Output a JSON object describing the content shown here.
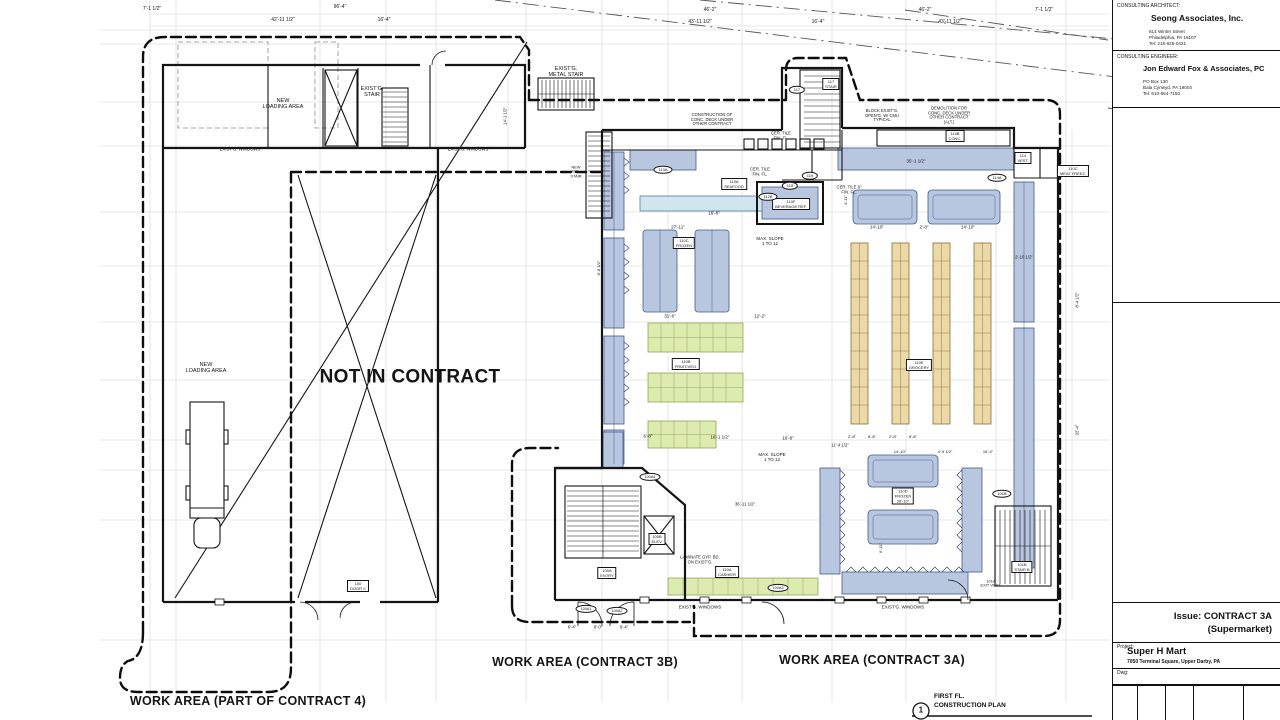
{
  "colors": {
    "fixture_blue": "#b9c6e0",
    "fixture_blue_border": "#44598c",
    "aqua": "#cfe6f0",
    "produce_green": "#dcebae",
    "produce_border": "#98a35c",
    "shelf_tan": "#ecd9a8",
    "shelf_border": "#8a6d3b",
    "line": "#141414"
  },
  "title_block": {
    "architect": {
      "label": "CONSULTING ARCHITECT:",
      "name": "Seong Associates, Inc.",
      "addr1": "814 Winter Street",
      "addr2": "Philadelphia, PA 19107",
      "addr3": "Tel: 215-925-0421"
    },
    "engineer": {
      "label": "CONSULTING ENGINEER:",
      "name": "Jon Edward Fox & Associates, PC",
      "addr1": "PO Box 130",
      "addr2": "Bala Cynwyd, PA 19004",
      "addr3": "Tel: 610-664-7150"
    },
    "issue": {
      "line1": "Issue: CONTRACT 3A",
      "line2": "(Supermarket)"
    },
    "project": {
      "label": "Project:",
      "name": "Super H Mart",
      "address": "7050 Terminal Square, Upper Darby, PA"
    },
    "dwg_label": "Dwg:"
  },
  "drawing_title": {
    "number": "1",
    "line1": "FIRST FL.",
    "line2": "CONSTRUCTION PLAN"
  },
  "plan": {
    "labels": [
      {
        "t": "7'-1 1/2\"",
        "x": 152,
        "y": 10,
        "s": 5
      },
      {
        "t": "96'-4\"",
        "x": 340,
        "y": 8,
        "s": 5
      },
      {
        "t": "42'-11 1/2\"",
        "x": 283,
        "y": 21,
        "s": 5
      },
      {
        "t": "16'-4\"",
        "x": 384,
        "y": 21,
        "s": 5
      },
      {
        "t": "46'-2\"",
        "x": 710,
        "y": 11,
        "s": 5
      },
      {
        "t": "46'-2\"",
        "x": 925,
        "y": 11,
        "s": 5
      },
      {
        "t": "7'-1 1/2\"",
        "x": 1044,
        "y": 11,
        "s": 5
      },
      {
        "t": "43'-11 1/2\"",
        "x": 700,
        "y": 23,
        "s": 5
      },
      {
        "t": "16'-4\"",
        "x": 818,
        "y": 23,
        "s": 5
      },
      {
        "t": "43'-11 1/2\"",
        "x": 950,
        "y": 23,
        "s": 5
      },
      {
        "t": "NEW\nLOADING AREA",
        "x": 283,
        "y": 104,
        "s": 5.5
      },
      {
        "t": "EXIST'G.\nSTAIR",
        "x": 372,
        "y": 92,
        "s": 5.5
      },
      {
        "t": "EXIST'G. WINDOWS",
        "x": 240,
        "y": 150,
        "s": 4.3
      },
      {
        "t": "EXIST'G. WINDOWS",
        "x": 468,
        "y": 150,
        "s": 4.3
      },
      {
        "t": "EXIST'G.\nMETAL STAIR",
        "x": 566,
        "y": 72,
        "s": 5.5
      },
      {
        "t": "NEW\nMTL.\nSTAIR",
        "x": 576,
        "y": 172,
        "s": 3.9
      },
      {
        "t": "NEW\nLOADING AREA",
        "x": 206,
        "y": 368,
        "s": 5.5
      },
      {
        "t": "NOT IN CONTRACT",
        "x": 410,
        "y": 377,
        "s": 19,
        "b": 1,
        "n": "label-not-in-contract"
      },
      {
        "t": "WORK AREA (PART OF CONTRACT 4)",
        "x": 248,
        "y": 701,
        "s": 12.5,
        "b": 1,
        "n": "label-work-area-contract4"
      },
      {
        "t": "WORK AREA (CONTRACT 3B)",
        "x": 585,
        "y": 662,
        "s": 12.5,
        "b": 1,
        "n": "label-work-area-contract3b"
      },
      {
        "t": "WORK AREA (CONTRACT 3A)",
        "x": 872,
        "y": 660,
        "s": 12.5,
        "b": 1,
        "n": "label-work-area-contract3a"
      },
      {
        "t": "CONSTRUCTION OF\nCONC. DECK UNDER\nOTHER CONTRACT",
        "x": 712,
        "y": 120,
        "s": 4.2
      },
      {
        "t": "BLOCK EXIST'G.\nOPEN'G. W/ CMU\nTYPICAL",
        "x": 882,
        "y": 116,
        "s": 4.2
      },
      {
        "t": "DEMOLITION FOR\nCONC. DECK UNDER\nOTHER CONTRACT\n(ALT.)",
        "x": 949,
        "y": 116,
        "s": 4.2
      },
      {
        "t": "CER. TILE\nFIN. FL.",
        "x": 781,
        "y": 136,
        "s": 4.2
      },
      {
        "t": "CER. TILE\nFIN. FL.",
        "x": 760,
        "y": 172,
        "s": 4.2
      },
      {
        "t": "CER. TILE 6\"\nFIN. FL.",
        "x": 849,
        "y": 190,
        "s": 4.2
      },
      {
        "t": "MAX. SLOPE\n1 TO 12",
        "x": 770,
        "y": 241,
        "s": 4.5
      },
      {
        "t": "MAX. SLOPE\n1 TO 12",
        "x": 772,
        "y": 457,
        "s": 4.5
      },
      {
        "t": "LAMINATE GYP. BD.\nON EXIST'G.",
        "x": 700,
        "y": 560,
        "s": 4.2
      },
      {
        "t": "EXIST'G. WINDOWS",
        "x": 700,
        "y": 607,
        "s": 4.5
      },
      {
        "t": "EXIST'G. WINDOWS",
        "x": 903,
        "y": 607,
        "s": 4.5
      },
      {
        "t": "117\nSTAIR",
        "x": 831,
        "y": 84,
        "s": 4,
        "box": 1
      },
      {
        "t": "114B\nCONC.",
        "x": 955,
        "y": 136,
        "s": 4,
        "box": 1
      },
      {
        "t": "114\nVEST.",
        "x": 1023,
        "y": 158,
        "s": 4,
        "box": 1
      },
      {
        "t": "110C\nMEAT FREEZ.",
        "x": 1073,
        "y": 171,
        "s": 4,
        "box": 1
      },
      {
        "t": "113A\nSEAFOOD",
        "x": 734,
        "y": 184,
        "s": 4,
        "box": 1
      },
      {
        "t": "110F\nBEVERAGE REF.",
        "x": 791,
        "y": 204,
        "s": 4,
        "box": 1
      },
      {
        "t": "110C\nFROZEN",
        "x": 684,
        "y": 243,
        "s": 4,
        "box": 1
      },
      {
        "t": "110B\nFRUIT/VEG.",
        "x": 686,
        "y": 364,
        "s": 4,
        "box": 1
      },
      {
        "t": "110E\nGROCERY",
        "x": 919,
        "y": 365,
        "s": 4,
        "box": 1
      },
      {
        "t": "110D\nFROZEN\n26'-10\"",
        "x": 903,
        "y": 496,
        "s": 4,
        "box": 1
      },
      {
        "t": "110A\nCASHIER",
        "x": 727,
        "y": 572,
        "s": 4,
        "box": 1
      },
      {
        "t": "101B\nSTAIR B",
        "x": 1022,
        "y": 567,
        "s": 4,
        "box": 1
      },
      {
        "t": "101A\nEXIT VEST.",
        "x": 991,
        "y": 584,
        "s": 4
      },
      {
        "t": "100B\nELEV.",
        "x": 657,
        "y": 539,
        "s": 4,
        "box": 1
      },
      {
        "t": "100A\nENTRY",
        "x": 607,
        "y": 573,
        "s": 4,
        "box": 1
      },
      {
        "t": "100\nDOOR C",
        "x": 358,
        "y": 586,
        "s": 4,
        "box": 1
      },
      {
        "t": "117",
        "x": 797,
        "y": 90,
        "s": 4,
        "oval": 1
      },
      {
        "t": "119",
        "x": 810,
        "y": 176,
        "s": 4,
        "oval": 1
      },
      {
        "t": "115",
        "x": 790,
        "y": 186,
        "s": 4,
        "oval": 1
      },
      {
        "t": "112B",
        "x": 768,
        "y": 197,
        "s": 4,
        "oval": 1
      },
      {
        "t": "113A",
        "x": 663,
        "y": 170,
        "s": 4,
        "oval": 1
      },
      {
        "t": "114A",
        "x": 997,
        "y": 178,
        "s": 4,
        "oval": 1
      },
      {
        "t": "101B",
        "x": 1002,
        "y": 494,
        "s": 4,
        "oval": 1
      },
      {
        "t": "100A4",
        "x": 650,
        "y": 477,
        "s": 3.8,
        "oval": 1
      },
      {
        "t": "100A1",
        "x": 586,
        "y": 609,
        "s": 3.8,
        "oval": 1
      },
      {
        "t": "100A2",
        "x": 617,
        "y": 611,
        "s": 3.8,
        "oval": 1
      },
      {
        "t": "100A3",
        "x": 778,
        "y": 588,
        "s": 3.8,
        "oval": 1
      },
      {
        "t": "14'-1 1/2\"",
        "x": 506,
        "y": 116,
        "s": 4.2,
        "r": -90
      },
      {
        "t": "35'-1 1/2\"",
        "x": 916,
        "y": 161,
        "s": 4.5
      },
      {
        "t": "27'-11\"",
        "x": 678,
        "y": 227,
        "s": 4.5
      },
      {
        "t": "16'-8\"",
        "x": 714,
        "y": 213,
        "s": 4.5
      },
      {
        "t": "14'-10\"",
        "x": 877,
        "y": 227,
        "s": 4.5
      },
      {
        "t": "2'-8\"",
        "x": 924,
        "y": 227,
        "s": 4.5
      },
      {
        "t": "14'-10\"",
        "x": 968,
        "y": 227,
        "s": 4.5
      },
      {
        "t": "2'-10 1/2\"",
        "x": 1024,
        "y": 258,
        "s": 4.3
      },
      {
        "t": "2'-8\"",
        "x": 852,
        "y": 437,
        "s": 4
      },
      {
        "t": "8'-8\"",
        "x": 872,
        "y": 437,
        "s": 4
      },
      {
        "t": "2'-8\"",
        "x": 893,
        "y": 437,
        "s": 4
      },
      {
        "t": "8'-8\"",
        "x": 913,
        "y": 437,
        "s": 4
      },
      {
        "t": "31'-6\"",
        "x": 670,
        "y": 316,
        "s": 4.5
      },
      {
        "t": "12'-2\"",
        "x": 760,
        "y": 316,
        "s": 4.5
      },
      {
        "t": "6'-8\"",
        "x": 648,
        "y": 436,
        "s": 4.5
      },
      {
        "t": "16'-1 1/2\"",
        "x": 720,
        "y": 437,
        "s": 4.5
      },
      {
        "t": "16'-8\"",
        "x": 788,
        "y": 438,
        "s": 4.5
      },
      {
        "t": "11'-4 1/2\"",
        "x": 840,
        "y": 446,
        "s": 4.3
      },
      {
        "t": "36'-11 1/2\"",
        "x": 745,
        "y": 505,
        "s": 4.3
      },
      {
        "t": "14'-10\"",
        "x": 900,
        "y": 452,
        "s": 4
      },
      {
        "t": "4'-9 1/2\"",
        "x": 945,
        "y": 452,
        "s": 4
      },
      {
        "t": "16'-4\"",
        "x": 988,
        "y": 452,
        "s": 4
      },
      {
        "t": "6'-4\"",
        "x": 572,
        "y": 628,
        "s": 4.2
      },
      {
        "t": "8'-0\"",
        "x": 598,
        "y": 628,
        "s": 4.2
      },
      {
        "t": "6'-4\"",
        "x": 624,
        "y": 628,
        "s": 4.2
      },
      {
        "t": "8'-4 1/2\"",
        "x": 1078,
        "y": 300,
        "s": 4.2,
        "r": -90
      },
      {
        "t": "32'-4\"",
        "x": 1078,
        "y": 430,
        "s": 4.2,
        "r": -90
      },
      {
        "t": "6'-11\"",
        "x": 881,
        "y": 548,
        "s": 4,
        "r": -90
      },
      {
        "t": "8'-8 1/2\"",
        "x": 599,
        "y": 268,
        "s": 4,
        "r": -90
      },
      {
        "t": "4'-11\"",
        "x": 846,
        "y": 200,
        "s": 4,
        "r": -90
      }
    ]
  }
}
